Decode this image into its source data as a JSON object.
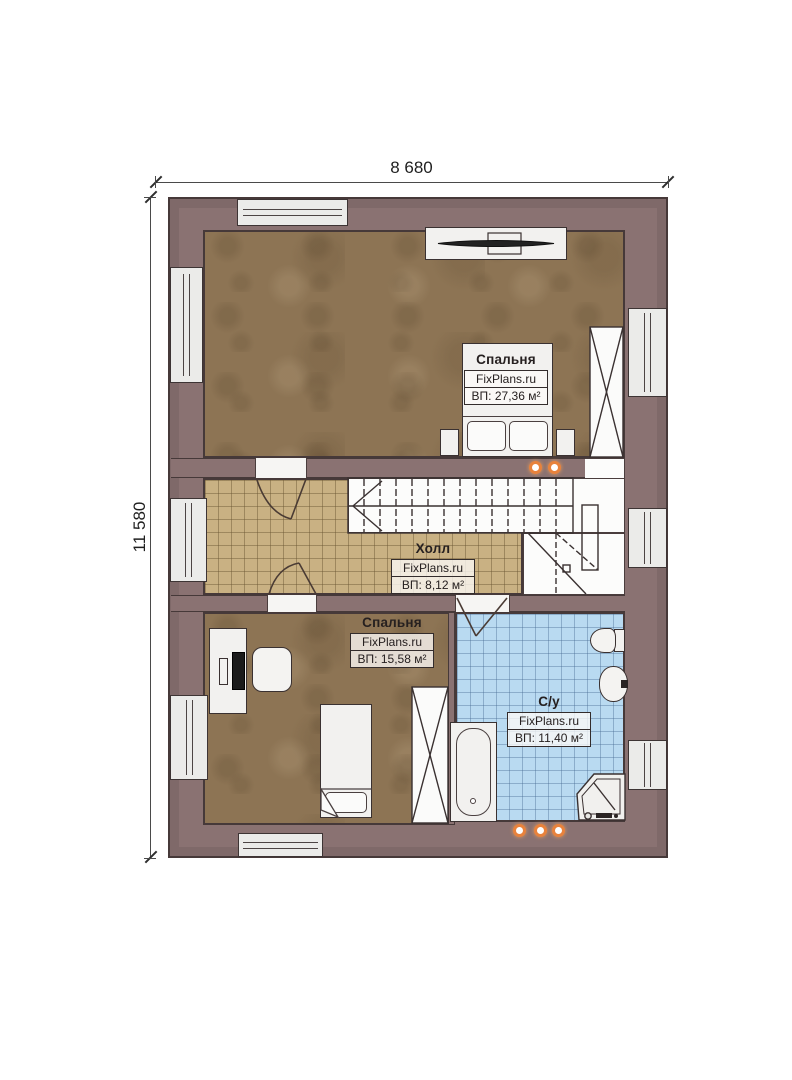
{
  "dimensions": {
    "width_label": "8 680",
    "height_label": "11 580"
  },
  "rooms": [
    {
      "id": "bedroom-top",
      "title": "Спальня",
      "brand": "FixPlans.ru",
      "area": "ВП: 27,36 м²"
    },
    {
      "id": "hall",
      "title": "Холл",
      "brand": "FixPlans.ru",
      "area": "ВП: 8,12 м²"
    },
    {
      "id": "bedroom-bottom",
      "title": "Спальня",
      "brand": "FixPlans.ru",
      "area": "ВП: 15,58 м²"
    },
    {
      "id": "bathroom",
      "title": "С/у",
      "brand": "FixPlans.ru",
      "area": "ВП: 11,40 м²"
    }
  ],
  "colors": {
    "wall": "#8a7272",
    "wall-line": "#463939",
    "bedroom-floor": "#8d7454",
    "hall-floor": "#c9b183",
    "bath-floor": "#b9daf1",
    "spotlight": "#e8823c",
    "line": "#3a3131"
  }
}
